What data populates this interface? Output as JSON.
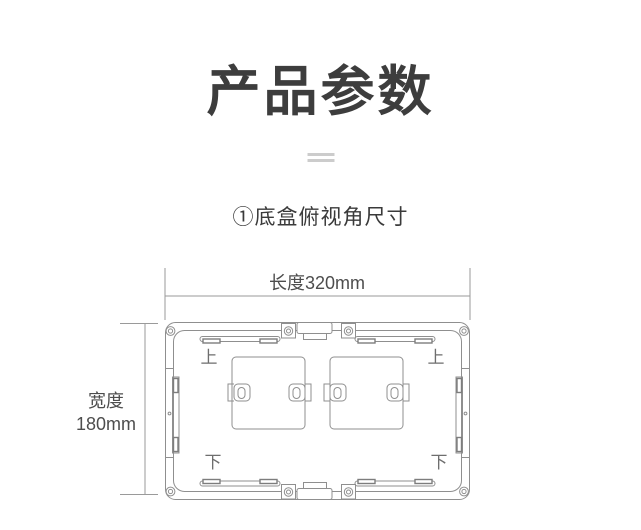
{
  "page": {
    "title": "产品参数",
    "section_label": "①底盒俯视角尺寸"
  },
  "diagram": {
    "length_label": "长度320mm",
    "width_label": [
      "宽度",
      "180mm"
    ],
    "length_mm": 320,
    "width_mm": 180,
    "marks": {
      "top_left": "上",
      "top_right": "上",
      "bottom_left": "下",
      "bottom_right": "下"
    }
  },
  "colors": {
    "title_text": "#3d3d3d",
    "dimension_text": "#4d4d4d",
    "line_gray": "#8f8f8f",
    "divider_gray": "#cccccc",
    "background": "#ffffff"
  }
}
